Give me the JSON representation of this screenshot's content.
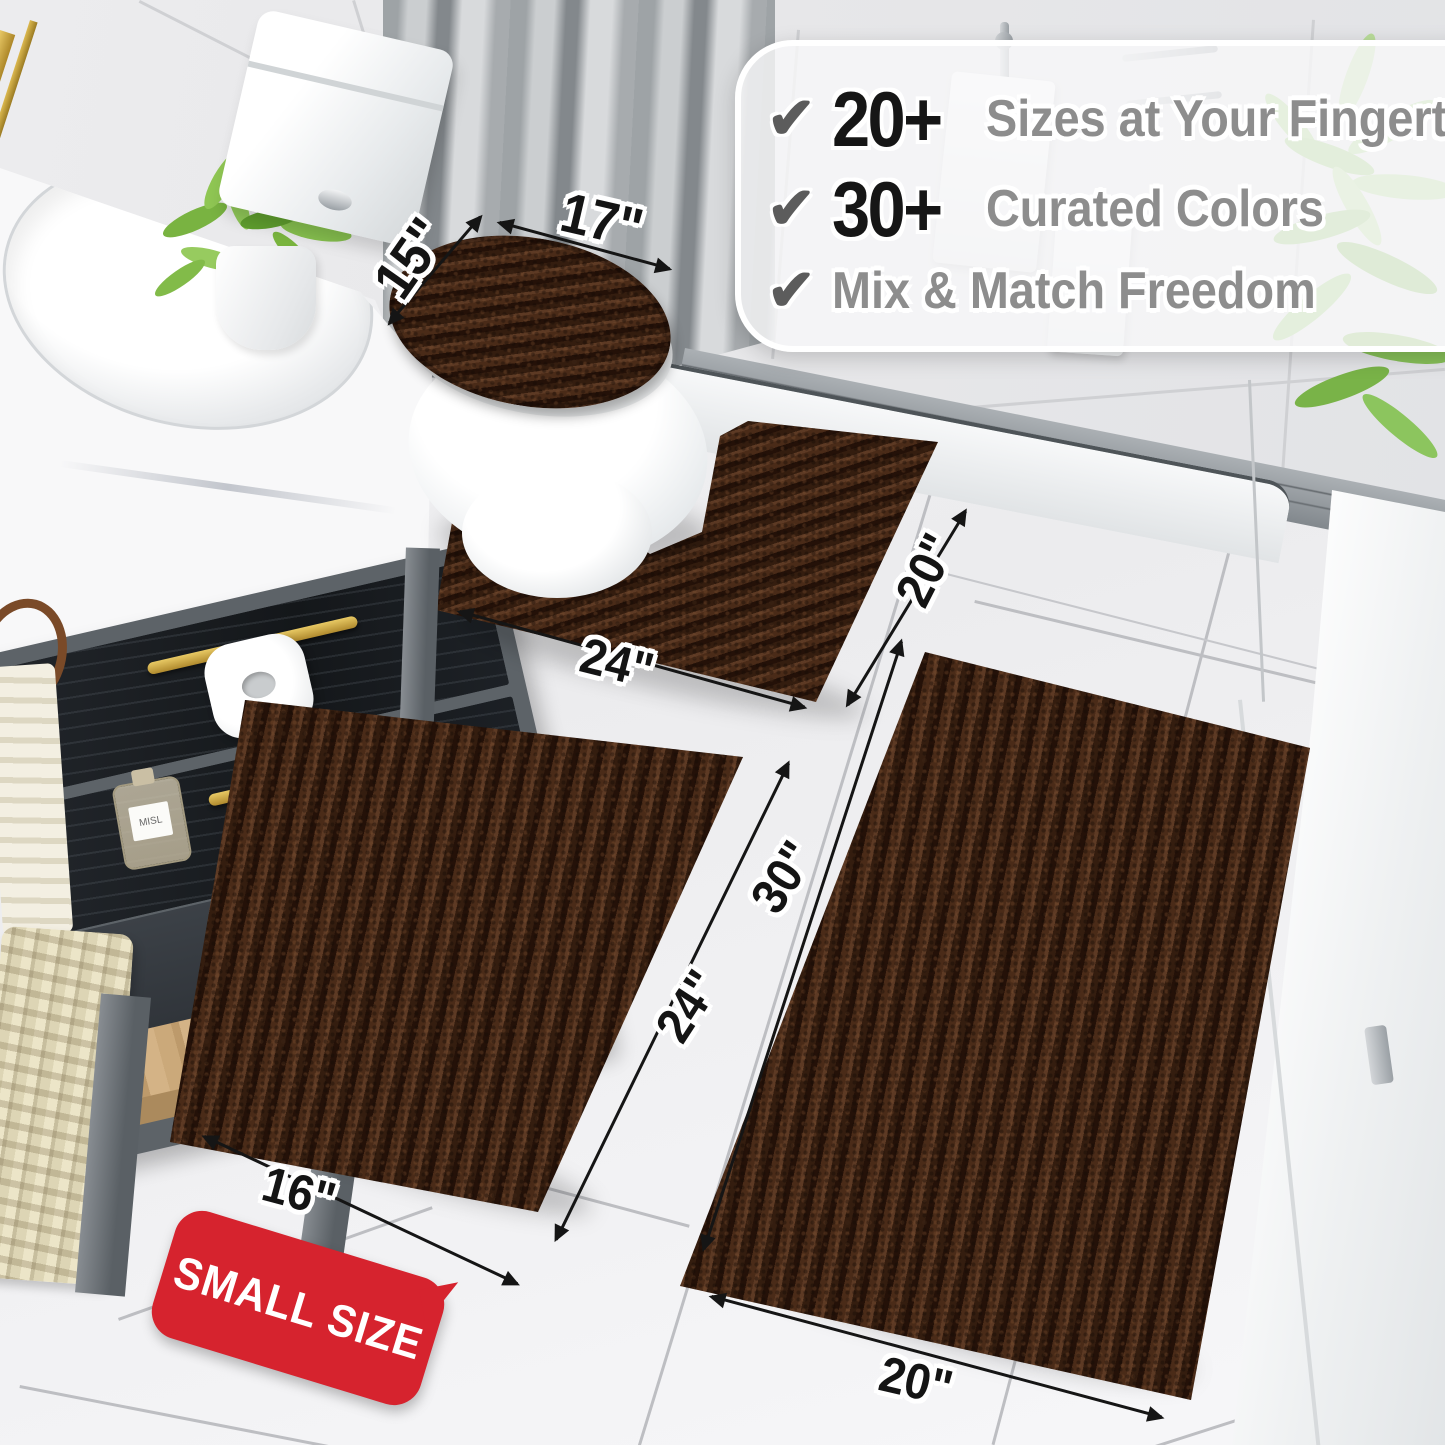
{
  "callout": {
    "rows": [
      {
        "check": "✔",
        "number": "20+",
        "label": "Sizes at Your Fingertips"
      },
      {
        "check": "✔",
        "number": "30+",
        "label": "Curated Colors"
      },
      {
        "check": "✔",
        "number": "",
        "label": "Mix & Match Freedom"
      }
    ]
  },
  "dimensions": {
    "lid_top": "17\"",
    "lid_side": "15\"",
    "contour_width": "24\"",
    "contour_depth": "20\"",
    "small_width": "16\"",
    "small_length": "24\"",
    "large_width": "20\"",
    "large_length": "30\""
  },
  "badge": {
    "label": "SMALL SIZE"
  },
  "bottle_label": "MISL",
  "colors": {
    "rug_brown": "#3a2114",
    "badge_red": "#d6232e",
    "feature_number": "#161616",
    "feature_text": "#8d8d8d",
    "check_gray": "#5c5c5c",
    "dimension_text": "#141414",
    "gold_accent": "#c9a344",
    "leaf_green": "#8cc063"
  }
}
